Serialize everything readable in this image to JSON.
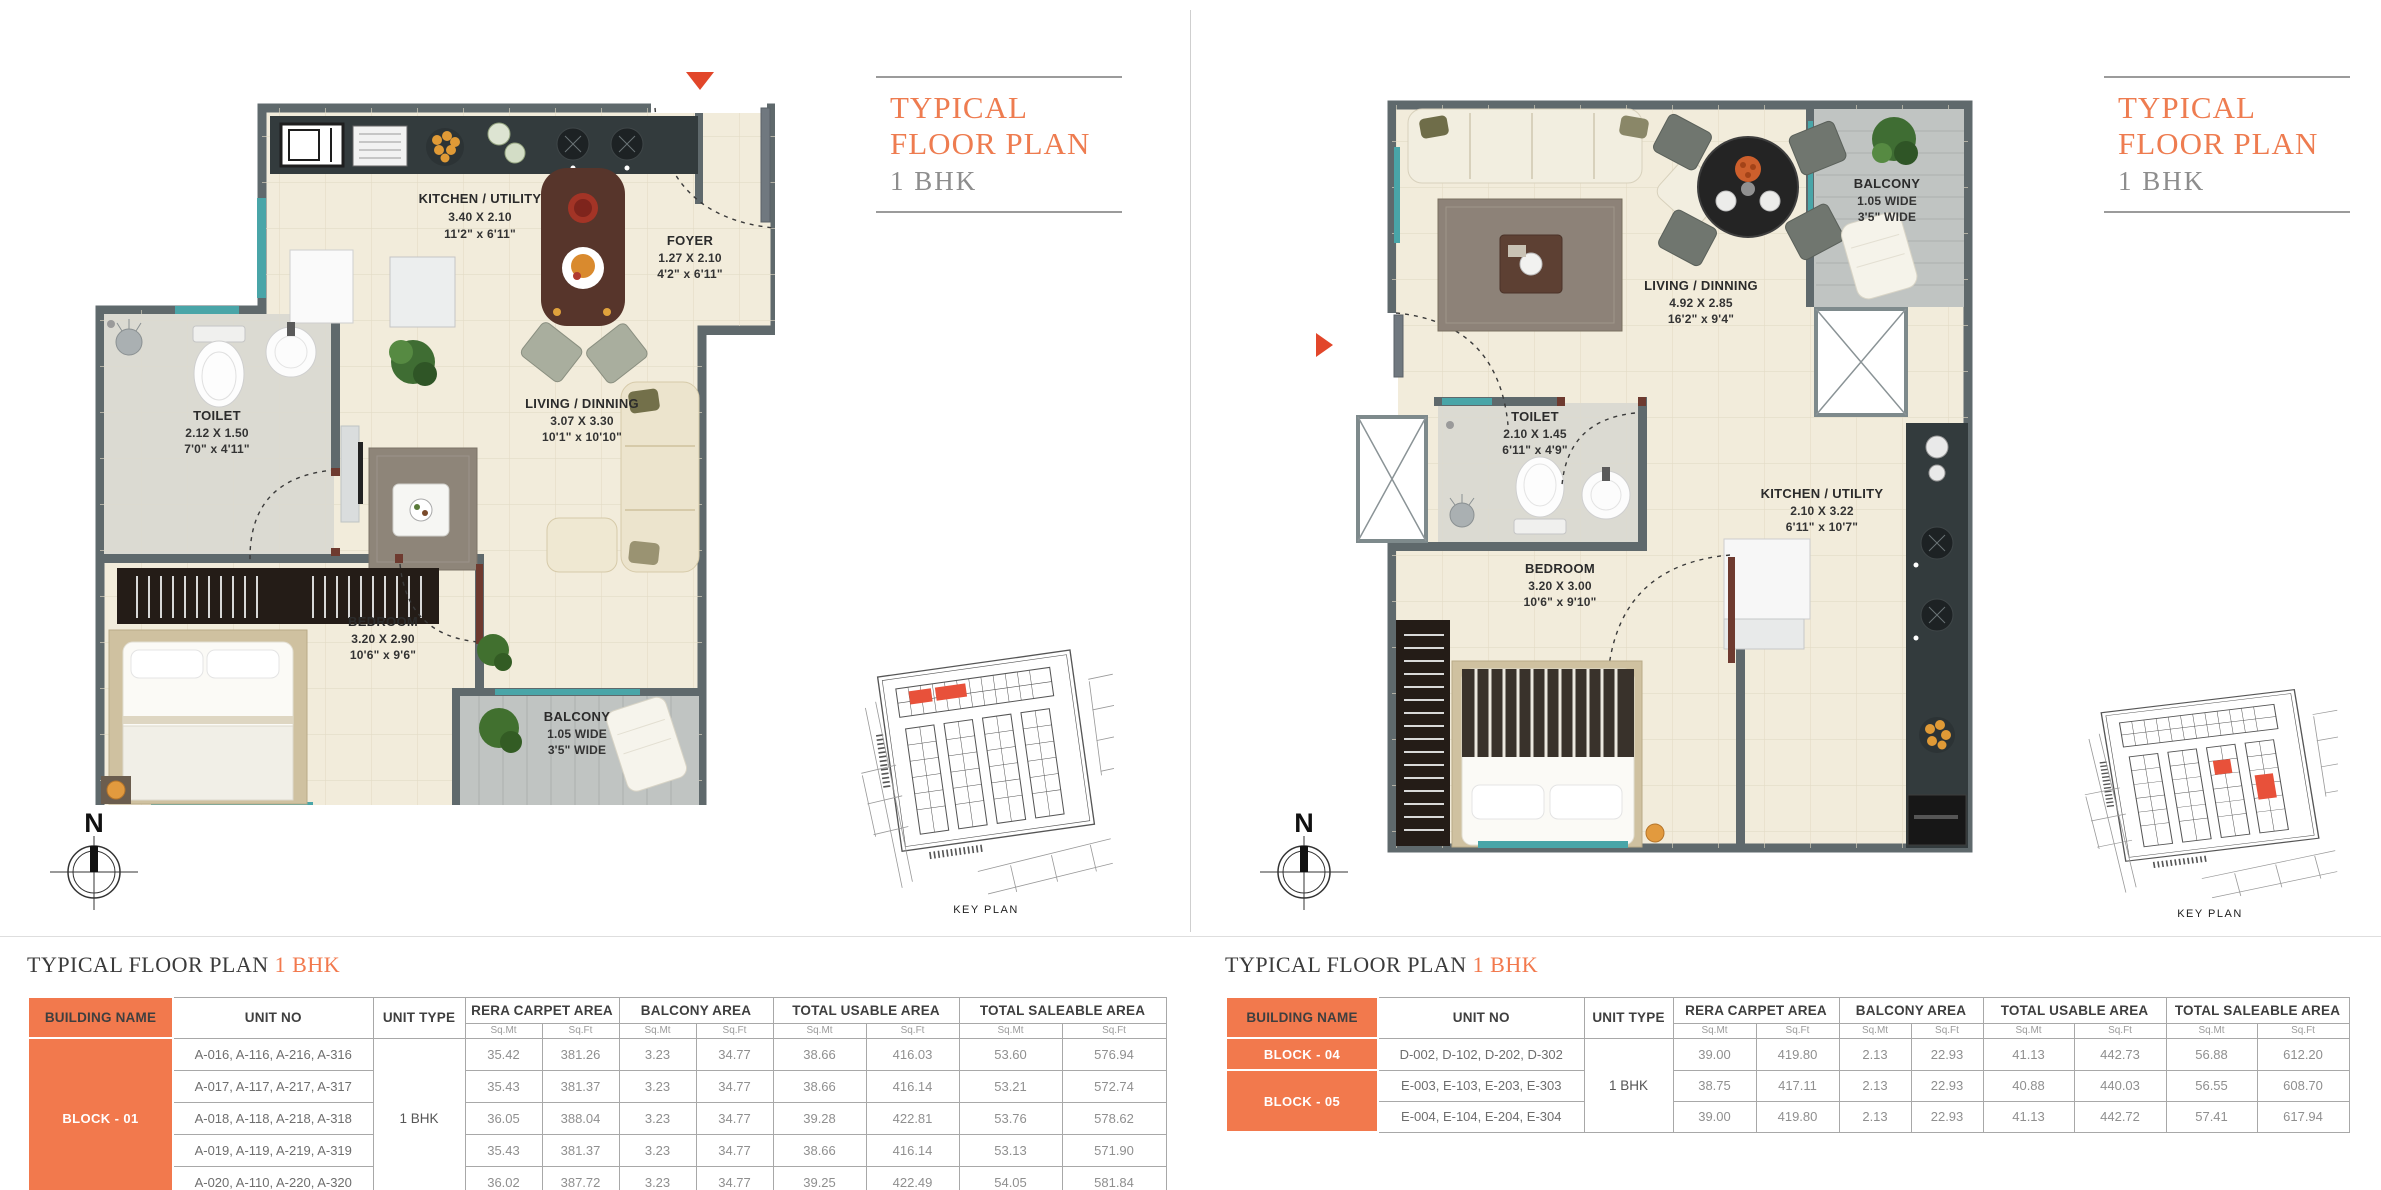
{
  "colors": {
    "accent": "#f2794d",
    "marker_red": "#e2462a",
    "wall_gray": "#5f696c",
    "window_teal": "#49a5a8",
    "keyplan_highlight": "#e8513a"
  },
  "left_panel": {
    "title_block": {
      "line1": "TYPICAL",
      "line2": "FLOOR PLAN",
      "line3": "1 BHK"
    },
    "compass_label": "N",
    "key_plan_caption": "KEY PLAN",
    "rooms": {
      "kitchen": {
        "name": "KITCHEN / UTILITY",
        "dim_m": "3.40 X 2.10",
        "dim_ft": "11'2\" x 6'11\""
      },
      "foyer": {
        "name": "FOYER",
        "dim_m": "1.27 X 2.10",
        "dim_ft": "4'2\" x 6'11\""
      },
      "toilet": {
        "name": "TOILET",
        "dim_m": "2.12 X 1.50",
        "dim_ft": "7'0\" x 4'11\""
      },
      "living": {
        "name": "LIVING / DINNING",
        "dim_m": "3.07 X 3.30",
        "dim_ft": "10'1\" x 10'10\""
      },
      "bedroom": {
        "name": "BEDROOM",
        "dim_m": "3.20 X 2.90",
        "dim_ft": "10'6\" x 9'6\""
      },
      "balcony": {
        "name": "BALCONY",
        "dim_m": "1.05 WIDE",
        "dim_ft": "3'5\" WIDE"
      }
    },
    "table": {
      "title_prefix": "TYPICAL FLOOR PLAN",
      "title_accent": "1 BHK",
      "col_building": "BUILDING NAME",
      "col_unit_no": "UNIT NO",
      "col_unit_type": "UNIT TYPE",
      "col_groups": [
        "RERA CARPET AREA",
        "BALCONY AREA",
        "TOTAL USABLE AREA",
        "TOTAL SALEABLE AREA"
      ],
      "sub_mt": "Sq.Mt",
      "sub_ft": "Sq.Ft",
      "block": "BLOCK - 01",
      "unit_type": "1 BHK",
      "rows": [
        {
          "units": "A-016, A-116, A-216, A-316",
          "v": [
            "35.42",
            "381.26",
            "3.23",
            "34.77",
            "38.66",
            "416.03",
            "53.60",
            "576.94"
          ]
        },
        {
          "units": "A-017, A-117, A-217, A-317",
          "v": [
            "35.43",
            "381.37",
            "3.23",
            "34.77",
            "38.66",
            "416.14",
            "53.21",
            "572.74"
          ]
        },
        {
          "units": "A-018, A-118, A-218, A-318",
          "v": [
            "36.05",
            "388.04",
            "3.23",
            "34.77",
            "39.28",
            "422.81",
            "53.76",
            "578.62"
          ]
        },
        {
          "units": "A-019, A-119, A-219, A-319",
          "v": [
            "35.43",
            "381.37",
            "3.23",
            "34.77",
            "38.66",
            "416.14",
            "53.13",
            "571.90"
          ]
        },
        {
          "units": "A-020, A-110, A-220, A-320",
          "v": [
            "36.02",
            "387.72",
            "3.23",
            "34.77",
            "39.25",
            "422.49",
            "54.05",
            "581.84"
          ]
        }
      ]
    }
  },
  "right_panel": {
    "title_block": {
      "line1": "TYPICAL",
      "line2": "FLOOR PLAN",
      "line3": "1 BHK"
    },
    "compass_label": "N",
    "key_plan_caption": "KEY PLAN",
    "rooms": {
      "living": {
        "name": "LIVING / DINNING",
        "dim_m": "4.92 X 2.85",
        "dim_ft": "16'2\" x 9'4\""
      },
      "balcony": {
        "name": "BALCONY",
        "dim_m": "1.05 WIDE",
        "dim_ft": "3'5\" WIDE"
      },
      "toilet": {
        "name": "TOILET",
        "dim_m": "2.10 X 1.45",
        "dim_ft": "6'11\" x 4'9\""
      },
      "kitchen": {
        "name": "KITCHEN / UTILITY",
        "dim_m": "2.10 X 3.22",
        "dim_ft": "6'11\" x 10'7\""
      },
      "bedroom": {
        "name": "BEDROOM",
        "dim_m": "3.20 X 3.00",
        "dim_ft": "10'6\" x 9'10\""
      }
    },
    "table": {
      "title_prefix": "TYPICAL FLOOR PLAN",
      "title_accent": "1 BHK",
      "col_building": "BUILDING NAME",
      "col_unit_no": "UNIT NO",
      "col_unit_type": "UNIT TYPE",
      "col_groups": [
        "RERA CARPET AREA",
        "BALCONY AREA",
        "TOTAL USABLE AREA",
        "TOTAL SALEABLE AREA"
      ],
      "sub_mt": "Sq.Mt",
      "sub_ft": "Sq.Ft",
      "blocks": [
        {
          "name": "BLOCK - 04"
        },
        {
          "name": "BLOCK - 05"
        }
      ],
      "unit_type": "1 BHK",
      "rows": [
        {
          "units": "D-002, D-102, D-202, D-302",
          "v": [
            "39.00",
            "419.80",
            "2.13",
            "22.93",
            "41.13",
            "442.73",
            "56.88",
            "612.20"
          ]
        },
        {
          "units": "E-003, E-103, E-203, E-303",
          "v": [
            "38.75",
            "417.11",
            "2.13",
            "22.93",
            "40.88",
            "440.03",
            "56.55",
            "608.70"
          ]
        },
        {
          "units": "E-004, E-104, E-204, E-304",
          "v": [
            "39.00",
            "419.80",
            "2.13",
            "22.93",
            "41.13",
            "442.72",
            "57.41",
            "617.94"
          ]
        }
      ]
    }
  }
}
